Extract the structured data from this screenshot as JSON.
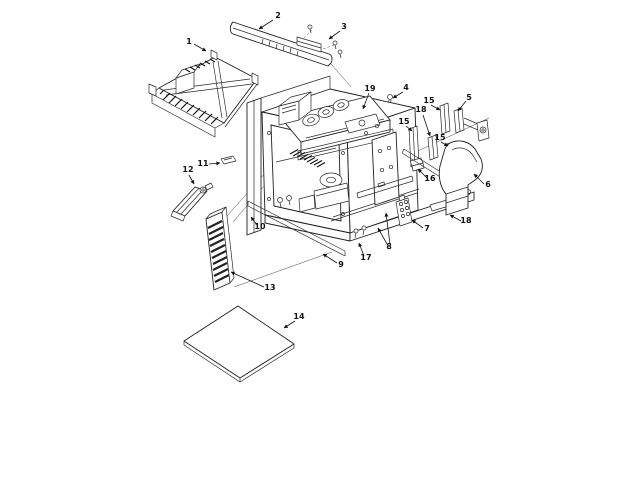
{
  "diagram": {
    "kind": "exploded-view-parts-diagram",
    "subject": "microwave-oven-cavity-assembly",
    "background_color": "#ffffff",
    "line_color": "#1f1f1f",
    "callout_count": 22
  },
  "callouts": [
    {
      "number": "1",
      "part_ref": "outer-case-top-wrapper"
    },
    {
      "number": "2",
      "part_ref": "vent-grille-bar"
    },
    {
      "number": "3",
      "part_ref": "grille-mounting-bracket-screws"
    },
    {
      "number": "4",
      "part_ref": "antenna-stud"
    },
    {
      "number": "5",
      "part_ref": "duct-support-bracket-assembly"
    },
    {
      "number": "6",
      "part_ref": "exhaust-air-duct"
    },
    {
      "number": "7",
      "part_ref": "terminal-block"
    },
    {
      "number": "8",
      "part_ref": "base-frame-mounting-points"
    },
    {
      "number": "9",
      "part_ref": "front-trim-strip-end"
    },
    {
      "number": "10",
      "part_ref": "front-trim-strip"
    },
    {
      "number": "11",
      "part_ref": "retainer-clip"
    },
    {
      "number": "12",
      "part_ref": "air-duct-wedge"
    },
    {
      "number": "13",
      "part_ref": "side-vent-grille-panel"
    },
    {
      "number": "14",
      "part_ref": "base-plate"
    },
    {
      "number": "15",
      "part_ref": "duct-mounting-bracket"
    },
    {
      "number": "15",
      "part_ref": "duct-mounting-bracket"
    },
    {
      "number": "15",
      "part_ref": "duct-mounting-bracket"
    },
    {
      "number": "16",
      "part_ref": "support-bracket"
    },
    {
      "number": "17",
      "part_ref": "mounting-screws"
    },
    {
      "number": "18",
      "part_ref": "duct-adapter-bracket"
    },
    {
      "number": "18",
      "part_ref": "duct-adapter-bracket"
    },
    {
      "number": "19",
      "part_ref": "stud-bolt"
    }
  ]
}
